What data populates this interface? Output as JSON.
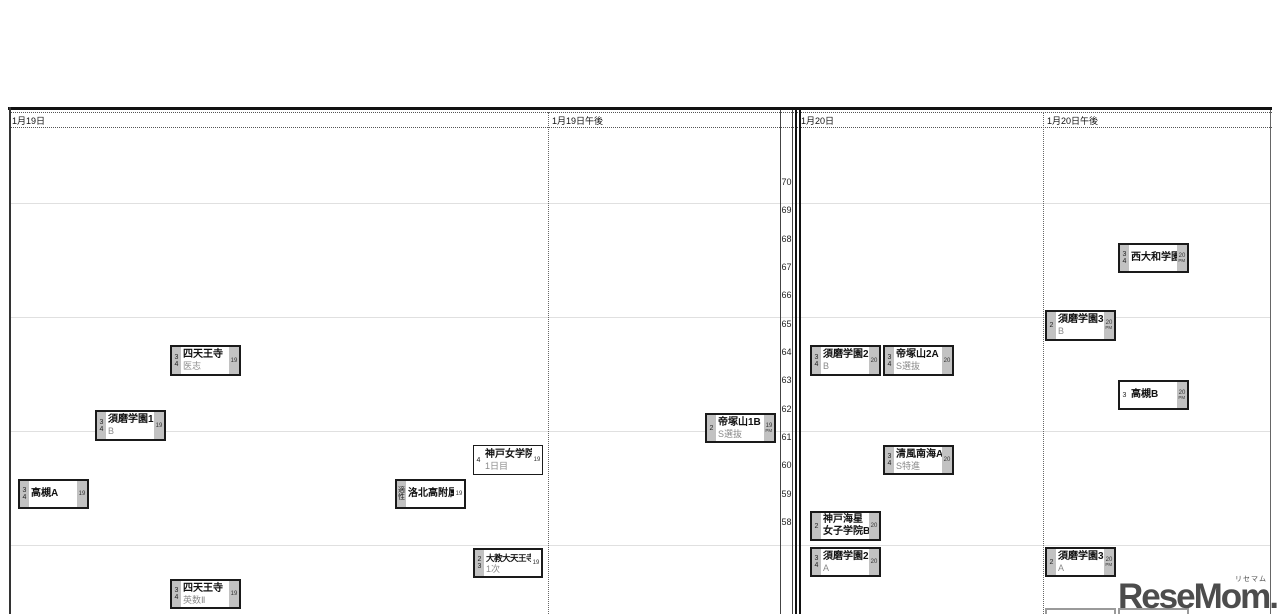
{
  "logo": {
    "text": "ReseMom.",
    "ruby": "リセマム"
  },
  "columns": [
    {
      "id": "jan19",
      "label": "1月19日",
      "label_x": 12
    },
    {
      "id": "jan19pm",
      "label": "1月19日午後",
      "label_x": 552
    },
    {
      "id": "jan20",
      "label": "1月20日",
      "label_x": 801
    },
    {
      "id": "jan20pm",
      "label": "1月20日午後",
      "label_x": 1047
    }
  ],
  "axis": {
    "ticks": [
      70,
      69,
      68,
      67,
      66,
      65,
      64,
      63,
      62,
      61,
      60,
      59,
      58
    ],
    "top_y": 177,
    "step": 28.33
  },
  "gridlines_y": [
    203,
    317,
    431,
    545
  ],
  "boxes": [
    {
      "id": "shitennoji-ishi",
      "name": "四天王寺",
      "course": "医志",
      "left": [
        "3",
        "4"
      ],
      "date": "19",
      "pm": false,
      "x": 170,
      "y": 345,
      "w": 71,
      "h": 31
    },
    {
      "id": "suma-gakuen-1b",
      "name": "須磨学園1",
      "course": "B",
      "left": [
        "3",
        "4"
      ],
      "date": "19",
      "pm": false,
      "x": 95,
      "y": 410,
      "w": 71,
      "h": 31
    },
    {
      "id": "takatsuki-a",
      "name": "高槻A",
      "course": "",
      "left": [
        "3",
        "4"
      ],
      "date": "19",
      "pm": false,
      "x": 18,
      "y": 479,
      "w": 71,
      "h": 30
    },
    {
      "id": "rakuhoku-kofuzoku",
      "name": "洛北高附属",
      "course": "",
      "left": [
        "適",
        "性"
      ],
      "date": "19",
      "pm": false,
      "right_plain": true,
      "x": 395,
      "y": 479,
      "w": 71,
      "h": 30
    },
    {
      "id": "kobe-jogakuin",
      "name": "神戸女学院",
      "course": "1日目",
      "left": [
        "4"
      ],
      "date": "19",
      "pm": false,
      "thin": true,
      "left_plain": true,
      "right_plain": true,
      "x": 473,
      "y": 445,
      "w": 70,
      "h": 30
    },
    {
      "id": "daikyodai-tennoji",
      "name": "大教大天王寺",
      "course": "1次",
      "small_name": true,
      "left": [
        "2",
        "3"
      ],
      "date": "19",
      "pm": false,
      "right_plain": true,
      "x": 473,
      "y": 548,
      "w": 70,
      "h": 30
    },
    {
      "id": "shitennoji-eisu2",
      "name": "四天王寺",
      "course": "英数Ⅱ",
      "left": [
        "3",
        "4"
      ],
      "date": "19",
      "pm": false,
      "x": 170,
      "y": 579,
      "w": 71,
      "h": 30
    },
    {
      "id": "tezukayama-1b",
      "name": "帝塚山1B",
      "course": "S選抜",
      "left": [
        "2"
      ],
      "date": "19",
      "pm": true,
      "x": 705,
      "y": 413,
      "w": 71,
      "h": 30
    },
    {
      "id": "suma-gakuen-2b",
      "name": "須磨学園2",
      "course": "B",
      "left": [
        "3",
        "4"
      ],
      "date": "20",
      "pm": false,
      "x": 810,
      "y": 345,
      "w": 71,
      "h": 31
    },
    {
      "id": "tezukayama-2a",
      "name": "帝塚山2A",
      "course": "S選抜",
      "left": [
        "3",
        "4"
      ],
      "date": "20",
      "pm": false,
      "x": 883,
      "y": 345,
      "w": 71,
      "h": 31
    },
    {
      "id": "seifu-nankai-a",
      "name": "清風南海A",
      "course": "S特進",
      "left": [
        "3",
        "4"
      ],
      "date": "20",
      "pm": false,
      "x": 883,
      "y": 445,
      "w": 71,
      "h": 30
    },
    {
      "id": "kobe-kaisei",
      "name": "神戸海星",
      "course": "女子学院B",
      "course_bold": true,
      "left": [
        "2"
      ],
      "date": "20",
      "pm": false,
      "x": 810,
      "y": 511,
      "w": 71,
      "h": 30
    },
    {
      "id": "suma-gakuen-2a",
      "name": "須磨学園2",
      "course": "A",
      "left": [
        "3",
        "4"
      ],
      "date": "20",
      "pm": false,
      "x": 810,
      "y": 547,
      "w": 71,
      "h": 30
    },
    {
      "id": "nishiyamato-gakuen",
      "name": "西大和学園",
      "course": "",
      "left": [
        "3",
        "4"
      ],
      "date": "20",
      "pm": true,
      "x": 1118,
      "y": 243,
      "w": 71,
      "h": 30
    },
    {
      "id": "suma-gakuen-3b",
      "name": "須磨学園3",
      "course": "B",
      "left": [
        "2"
      ],
      "date": "20",
      "pm": true,
      "x": 1045,
      "y": 310,
      "w": 71,
      "h": 31
    },
    {
      "id": "takatsuki-b",
      "name": "高槻B",
      "course": "",
      "left": [
        "3"
      ],
      "left_plain": true,
      "date": "20",
      "pm": true,
      "x": 1118,
      "y": 380,
      "w": 71,
      "h": 30
    },
    {
      "id": "suma-gakuen-3a",
      "name": "須磨学園3",
      "course": "A",
      "left": [
        "2"
      ],
      "date": "20",
      "pm": true,
      "x": 1045,
      "y": 547,
      "w": 71,
      "h": 30
    }
  ],
  "partial_boxes": [
    {
      "x": 1045,
      "y": 608,
      "w": 71
    },
    {
      "x": 1118,
      "y": 608,
      "w": 71
    }
  ],
  "chart_data": {
    "type": "scatter",
    "title": "中学入試 入試日程×偏差値マップ（1月19日〜1月20日午後）",
    "xlabel": "入試日程",
    "ylabel": "偏差値",
    "x_categories": [
      "1月19日",
      "1月19日午後",
      "1月20日",
      "1月20日午後"
    ],
    "y_ticks": [
      70,
      69,
      68,
      67,
      66,
      65,
      64,
      63,
      62,
      61,
      60,
      59,
      58
    ],
    "ylim": [
      58,
      70
    ],
    "grid": "light horizontal lines every 4 points",
    "points": [
      {
        "school": "四天王寺",
        "course": "医志",
        "session": "1月19日",
        "subjects": "3・4",
        "deviation": 64
      },
      {
        "school": "須磨学園1",
        "course": "B",
        "session": "1月19日",
        "subjects": "3・4",
        "deviation": 61
      },
      {
        "school": "高槻A",
        "course": "",
        "session": "1月19日",
        "subjects": "3・4",
        "deviation": 59
      },
      {
        "school": "洛北高附属",
        "course": "",
        "session": "1月19日",
        "subjects": "適性",
        "deviation": 59
      },
      {
        "school": "神戸女学院",
        "course": "1日目",
        "session": "1月19日",
        "subjects": "4",
        "deviation": 60
      },
      {
        "school": "大教大天王寺",
        "course": "1次",
        "session": "1月19日",
        "subjects": "2・3",
        "deviation": 57
      },
      {
        "school": "四天王寺",
        "course": "英数Ⅱ",
        "session": "1月19日",
        "subjects": "3・4",
        "deviation": 56
      },
      {
        "school": "帝塚山1B",
        "course": "S選抜",
        "session": "1月19日午後",
        "subjects": "2",
        "deviation": 61
      },
      {
        "school": "須磨学園2",
        "course": "B",
        "session": "1月20日",
        "subjects": "3・4",
        "deviation": 64
      },
      {
        "school": "帝塚山2A",
        "course": "S選抜",
        "session": "1月20日",
        "subjects": "3・4",
        "deviation": 64
      },
      {
        "school": "清風南海A",
        "course": "S特進",
        "session": "1月20日",
        "subjects": "3・4",
        "deviation": 60
      },
      {
        "school": "神戸海星女子学院B",
        "course": "",
        "session": "1月20日",
        "subjects": "2",
        "deviation": 58
      },
      {
        "school": "須磨学園2",
        "course": "A",
        "session": "1月20日",
        "subjects": "3・4",
        "deviation": 57
      },
      {
        "school": "西大和学園",
        "course": "",
        "session": "1月20日午後",
        "subjects": "3・4",
        "deviation": 67
      },
      {
        "school": "須磨学園3",
        "course": "B",
        "session": "1月20日午後",
        "subjects": "2",
        "deviation": 65
      },
      {
        "school": "高槻B",
        "course": "",
        "session": "1月20日午後",
        "subjects": "3",
        "deviation": 62
      },
      {
        "school": "須磨学園3",
        "course": "A",
        "session": "1月20日午後",
        "subjects": "2",
        "deviation": 57
      }
    ]
  }
}
